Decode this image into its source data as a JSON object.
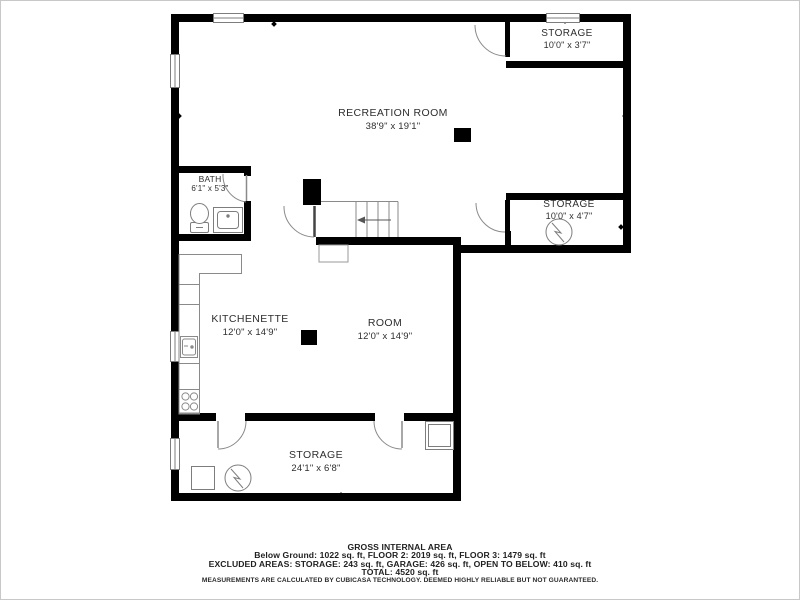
{
  "rooms": [
    {
      "id": "recreation-room",
      "name": "RECREATION ROOM",
      "dims": "38'9\" x 19'1\""
    },
    {
      "id": "storage-top-right",
      "name": "STORAGE",
      "dims": "10'0\" x 3'7\""
    },
    {
      "id": "storage-mid-right",
      "name": "STORAGE",
      "dims": "10'0\" x 4'7\""
    },
    {
      "id": "bath",
      "name": "BATH",
      "dims": "6'1\" x 5'3\""
    },
    {
      "id": "kitchenette",
      "name": "KITCHENETTE",
      "dims": "12'0\" x 14'9\""
    },
    {
      "id": "room",
      "name": "ROOM",
      "dims": "12'0\" x 14'9\""
    },
    {
      "id": "storage-bottom",
      "name": "STORAGE",
      "dims": "24'1\" x 6'8\""
    }
  ],
  "footer": {
    "title": "GROSS INTERNAL AREA",
    "line1": "Below Ground: 1022 sq. ft, FLOOR 2: 2019 sq. ft, FLOOR 3: 1479 sq. ft",
    "line2": "EXCLUDED AREAS: STORAGE: 243 sq. ft, GARAGE: 426 sq. ft, OPEN TO BELOW: 410 sq. ft",
    "line3": "TOTAL: 4520 sq. ft",
    "disclaimer": "MEASUREMENTS ARE CALCULATED BY CUBICASA TECHNOLOGY. DEEMED HIGHLY RELIABLE BUT NOT GUARANTEED."
  },
  "fixtures": [
    "toilet",
    "bathroom-sink",
    "kitchen-counter",
    "kitchen-sink",
    "stove",
    "water-heater",
    "stairs",
    "column"
  ],
  "colors": {
    "wall": "#000000",
    "fixture_stroke": "#7d7d7d",
    "door_stroke": "#8a8a8a",
    "text": "#2e2e2e",
    "frame": "#c8c8c8",
    "background": "#ffffff"
  }
}
